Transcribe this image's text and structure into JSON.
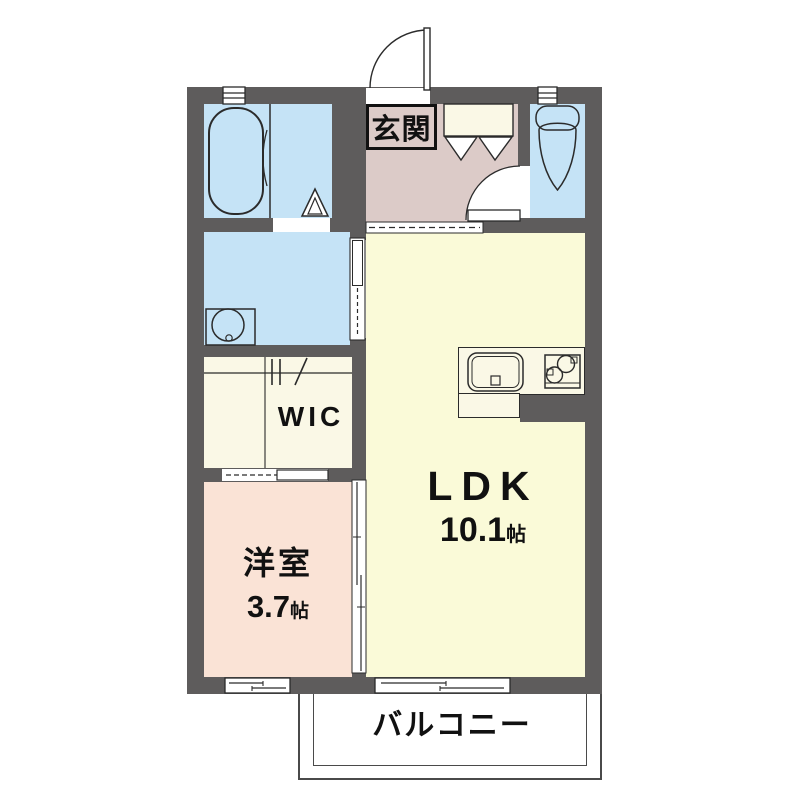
{
  "plan_type": "apartment-floor-plan",
  "rooms": {
    "entrance": {
      "label": "玄関"
    },
    "ldk": {
      "label": "LDK",
      "area_value": "10.1",
      "area_unit": "帖"
    },
    "western_room": {
      "label": "洋室",
      "area_value": "3.7",
      "area_unit": "帖"
    },
    "wic": {
      "label": "WIC"
    },
    "balcony": {
      "label": "バルコニー"
    }
  },
  "fixtures": {
    "bathtub": "bathtub-icon",
    "bath_door": "folding-door-icon",
    "washing_machine_pan": "washing-machine-icon",
    "toilet": "toilet-icon",
    "toilet_door": "swing-door-icon",
    "entrance_door": "swing-door-icon",
    "shoe_cabinet": "shoe-cabinet-icon",
    "kitchen_sink": "kitchen-sink-icon",
    "gas_stove": "stove-icon",
    "wic_hanger": "hanger-pipe-icon",
    "sliding_doors": "sliding-door-icon",
    "windows": "window-icon"
  },
  "colors": {
    "wall": "#5e5c5c",
    "water_room_floor": "#c5e3f6",
    "entrance_floor": "#dccbc8",
    "ldk_floor": "#fafad8",
    "closet_floor": "#faf8e6",
    "western_room_floor": "#fae3d6",
    "balcony_floor": "#ffffff",
    "line": "#2b2b2b"
  }
}
